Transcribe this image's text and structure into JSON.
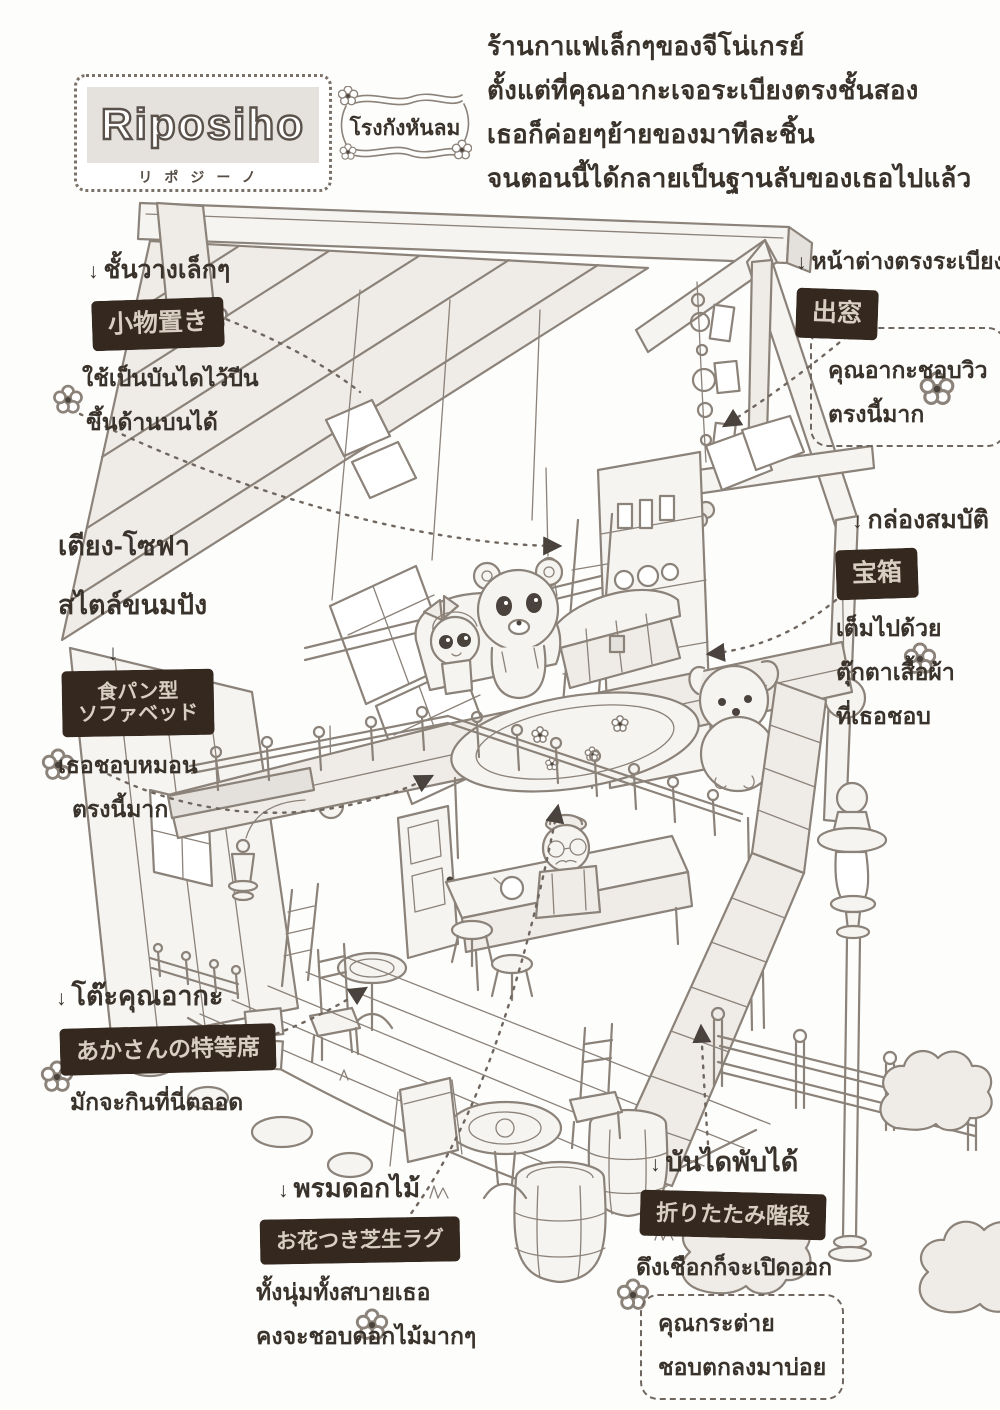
{
  "logo": {
    "title": "Riposiho",
    "subtitle": "リポジーノ",
    "tagline": "โรงกังหันลม"
  },
  "intro": {
    "line1": "ร้านกาแฟเล็กๆของจีโน่เกรย์",
    "line2": "ตั้งแต่ที่คุณอากะเจอระเบียงตรงชั้นสอง",
    "line3": "เธอก็ค่อยๆย้ายของมาทีละชิ้น",
    "line4": "จนตอนนี้ได้กลายเป็นฐานลับของเธอไปแล้ว"
  },
  "annotations": {
    "shelf": {
      "arrow": "↓",
      "title": "ชั้นวางเล็กๆ",
      "stamp": "小物置き",
      "line1": "ใช้เป็นบันไดไว้ปีน",
      "line2": "ขึ้นด้านบนได้"
    },
    "sofa": {
      "title1": "เตียง-โซฟา",
      "title2": "สไตล์ขนมปัง",
      "arrow": "↓",
      "stamp1": "食パン型",
      "stamp2": "ソファベッド",
      "line1": "เธอชอบหมอน",
      "line2": "ตรงนี้มาก"
    },
    "window": {
      "arrow": "↓",
      "title": "หน้าต่างตรงระเบียง",
      "stamp": "出窓",
      "line1": "คุณอากะชอบวิว",
      "line2": "ตรงนี้มาก"
    },
    "treasure": {
      "arrow": "↓",
      "title": "กล่องสมบัติ",
      "stamp": "宝箱",
      "line1": "เต็มไปด้วย",
      "line2": "ตุ๊กตาเสื้อผ้า",
      "line3": "ที่เธอชอบ"
    },
    "table": {
      "arrow": "↓",
      "title": "โต๊ะคุณอากะ",
      "stamp": "あかさんの特等席",
      "line1": "มักจะกินที่นี่ตลอด"
    },
    "rug": {
      "arrow": "↓",
      "title": "พรมดอกไม้",
      "stamp": "お花つき芝生ラグ",
      "line1": "ทั้งนุ่มทั้งสบายเธอ",
      "line2": "คงจะชอบดอกไม้มากๆ"
    },
    "stairs": {
      "arrow": "↓",
      "title": "บันไดพับได้",
      "stamp": "折りたたみ階段",
      "line1": "ดึงเชือกก็จะเปิดออก",
      "line2": "คุณกระต่าย",
      "line3": "ชอบตกลงมาบ่อย"
    }
  },
  "icons": {
    "flower": "✿",
    "arrow_down": "↓"
  },
  "colors": {
    "ink": "#3a332c",
    "line_art": "#8b8279",
    "stamp_bg": "#35281f",
    "stamp_text": "#d8cec1",
    "paper": "#fdfdfc"
  }
}
